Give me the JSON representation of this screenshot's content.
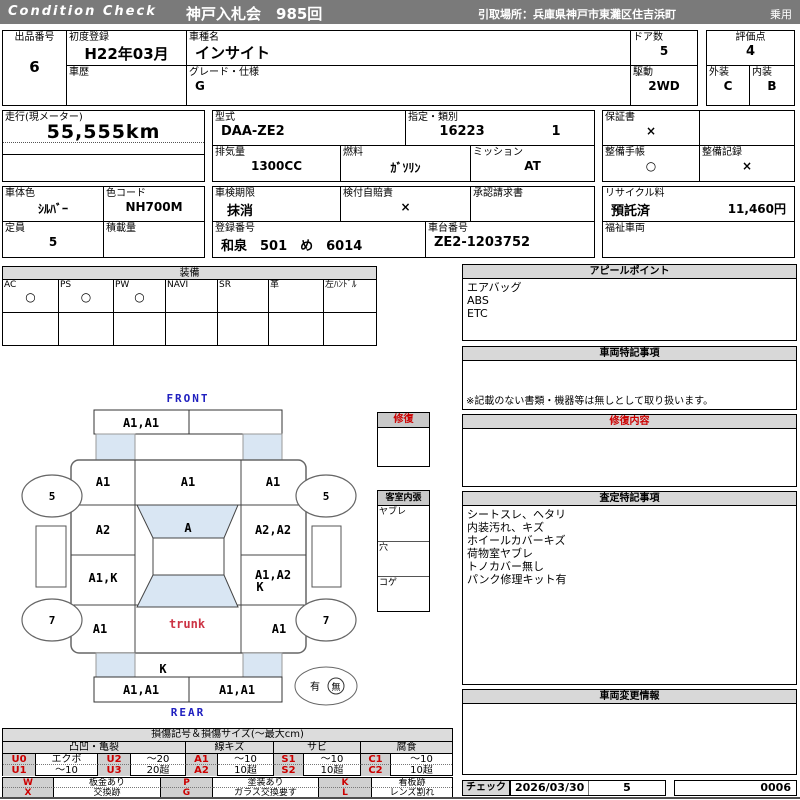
{
  "header": {
    "brand": "Condition  Check",
    "auction": "神戸入札会　985回",
    "pickup": "引取場所：兵庫県神戸市東灘区住吉浜町",
    "category": "乗用"
  },
  "info": {
    "lot": {
      "label": "出品番号",
      "value": "6"
    },
    "first_reg": {
      "label": "初度登録",
      "value": "H22年03月"
    },
    "history": {
      "label": "車歴",
      "value": ""
    },
    "model": {
      "label": "車種名",
      "value": "インサイト"
    },
    "grade": {
      "label": "グレード・仕様",
      "value": "G"
    },
    "doors": {
      "label": "ドア数",
      "value": "5"
    },
    "drive": {
      "label": "駆動",
      "value": "2WD"
    },
    "score": {
      "label": "評価点",
      "value": "4"
    },
    "exterior": {
      "label": "外装",
      "value": "C"
    },
    "interior": {
      "label": "内装",
      "value": "B"
    },
    "mileage": {
      "label": "走行(現メーター)",
      "value": "55,555km"
    },
    "model_code": {
      "label": "型式",
      "value": "DAA-ZE2"
    },
    "class": {
      "label": "指定・類別",
      "value1": "16223",
      "value2": "1"
    },
    "displacement": {
      "label": "排気量",
      "value": "1300CC"
    },
    "fuel": {
      "label": "燃料",
      "value": "ｶﾞｿﾘﾝ"
    },
    "mission": {
      "label": "ミッション",
      "value": "AT"
    },
    "warranty": {
      "label": "保証書",
      "value": "×"
    },
    "maint_book": {
      "label": "整備手帳",
      "value": "○"
    },
    "maint_record": {
      "label": "整備記録",
      "value": "×"
    },
    "body_color": {
      "label": "車体色",
      "value": "ｼﾙﾊﾞｰ"
    },
    "color_code": {
      "label": "色コード",
      "value": "NH700M"
    },
    "capacity": {
      "label": "定員",
      "value": "5"
    },
    "load": {
      "label": "積載量",
      "value": ""
    },
    "inspection": {
      "label": "車検期限",
      "value": "抹消"
    },
    "jibai": {
      "label": "検付自賠責",
      "value": "×"
    },
    "approval": {
      "label": "承認請求書",
      "value": ""
    },
    "reg_no": {
      "label": "登録番号",
      "value": "和泉　501　め　6014"
    },
    "chassis": {
      "label": "車台番号",
      "value": "ZE2-1203752"
    },
    "recycle": {
      "label": "リサイクル料",
      "status": "預託済",
      "fee": "11,460円"
    },
    "welfare": {
      "label": "福祉車両",
      "value": ""
    }
  },
  "equipment": {
    "title": "装備",
    "items": [
      {
        "label": "AC",
        "value": "○"
      },
      {
        "label": "PS",
        "value": "○"
      },
      {
        "label": "PW",
        "value": "○"
      },
      {
        "label": "NAVI",
        "value": ""
      },
      {
        "label": "SR",
        "value": ""
      },
      {
        "label": "革",
        "value": ""
      },
      {
        "label": "左ﾊﾝﾄﾞﾙ",
        "value": ""
      }
    ]
  },
  "panels": {
    "appeal": {
      "title": "アピールポイント",
      "items": [
        "エアバッグ",
        "ABS",
        "ETC"
      ]
    },
    "special": {
      "title": "車両特記事項",
      "note": "※記載のない書類・機器等は無しとして取り扱います。"
    },
    "repair": {
      "title": "修復内容"
    },
    "assessment": {
      "title": "査定特記事項",
      "items": [
        "シートスレ、ヘタリ",
        "内装汚れ、キズ",
        "ホイールカバーキズ",
        "荷物室ヤブレ",
        "トノカバー無し",
        "パンク修理キット有"
      ]
    },
    "change": {
      "title": "車両変更情報"
    },
    "check": {
      "label": "チェック",
      "date": "2026/03/30",
      "count": "5",
      "serial": "0006"
    }
  },
  "diagram": {
    "front_label": "FRONT",
    "rear_label": "REAR",
    "front_bumper_left": "A1,A1",
    "fender_left": "A1",
    "hood": "A1",
    "fender_right": "A1",
    "wheel_fl": "5",
    "wheel_fr": "5",
    "wheel_rl": "7",
    "wheel_rr": "7",
    "door_front_left": "A2",
    "windshield": "A",
    "door_front_right": "A2,A2",
    "door_rear_left": "A1,K",
    "door_rear_right": "A1,A2",
    "door_rear_right2": "K",
    "quarter_left": "A1",
    "trunk": "trunk",
    "quarter_right": "A1",
    "rear_panel": "K",
    "rear_bumper_left": "A1,A1",
    "rear_bumper_right": "A1,A1",
    "spare_present": "有",
    "spare_absent": "無",
    "repair_box_title": "修復",
    "cabin_title": "客室内張",
    "cabin_rows": [
      "ヤブレ",
      "穴",
      "コゲ"
    ]
  },
  "legend": {
    "title": "損傷記号＆損傷サイズ(〜最大cm)",
    "groups": [
      "凸凹・亀裂",
      "線キズ",
      "サビ",
      "腐食"
    ],
    "row1": [
      {
        "code": "U0",
        "desc": "エクボ"
      },
      {
        "code": "U2",
        "desc": "〜20"
      },
      {
        "code": "A1",
        "desc": "〜10"
      },
      {
        "code": "S1",
        "desc": "〜10"
      },
      {
        "code": "C1",
        "desc": "〜10"
      }
    ],
    "row2": [
      {
        "code": "U1",
        "desc": "〜10"
      },
      {
        "code": "U3",
        "desc": "20超"
      },
      {
        "code": "A2",
        "desc": "10超"
      },
      {
        "code": "S2",
        "desc": "10超"
      },
      {
        "code": "C2",
        "desc": "10超"
      }
    ],
    "codes2_row1": [
      {
        "code": "W",
        "desc": "板金あり"
      },
      {
        "code": "P",
        "desc": "塗装あり"
      },
      {
        "code": "K",
        "desc": "看板跡"
      }
    ],
    "codes2_row2": [
      {
        "code": "X",
        "desc": "交換跡"
      },
      {
        "code": "G",
        "desc": "ガラス交換要す"
      },
      {
        "code": "L",
        "desc": "レンズ割れ"
      }
    ]
  },
  "colors": {
    "topbar_gray": "#7a7a7a",
    "header_gray": "#d8d8d8",
    "glass_blue": "#d9e6f3",
    "label_blue": "#2020c0",
    "alert_red": "#cc0000"
  }
}
